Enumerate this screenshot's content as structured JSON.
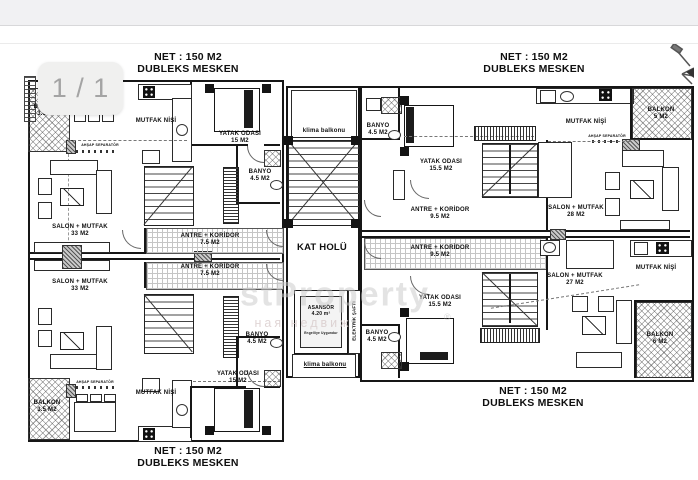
{
  "viewer": {
    "page_badge": "1 / 1"
  },
  "watermark": {
    "logo": "stProperty",
    "registered": "®",
    "tagline": "ная недвиж"
  },
  "plan": {
    "labels": [
      {
        "n": "unit-a-net",
        "t": "NET : 150 M2",
        "x": 188,
        "y": 51,
        "s": 10.5
      },
      {
        "n": "unit-a-type",
        "t": "DUBLEKS MESKEN",
        "x": 188,
        "y": 63,
        "s": 10.5
      },
      {
        "n": "unit-c-net",
        "t": "NET : 150 M2",
        "x": 534,
        "y": 51,
        "s": 10.5
      },
      {
        "n": "unit-c-type",
        "t": "DUBLEKS MESKEN",
        "x": 534,
        "y": 63,
        "s": 10.5
      },
      {
        "n": "unit-b-net",
        "t": "NET : 150 M2",
        "x": 188,
        "y": 445,
        "s": 10.5
      },
      {
        "n": "unit-b-type",
        "t": "DUBLEKS MESKEN",
        "x": 188,
        "y": 457,
        "s": 10.5
      },
      {
        "n": "unit-d-net",
        "t": "NET : 150 M2",
        "x": 533,
        "y": 385,
        "s": 10.5
      },
      {
        "n": "unit-d-type",
        "t": "DUBLEKS MESKEN",
        "x": 533,
        "y": 397,
        "s": 10.5
      },
      {
        "n": "a-balkon",
        "t": "BALKON\n3.5 M2",
        "x": 47,
        "y": 104,
        "s": 6
      },
      {
        "n": "a-mutfak-nisi",
        "t": "MUTFAK NİŞİ",
        "x": 156,
        "y": 118,
        "s": 6
      },
      {
        "n": "a-yatak-odasi",
        "t": "YATAK ODASI\n15 M2",
        "x": 240,
        "y": 131,
        "s": 6
      },
      {
        "n": "a-klima-balkonu",
        "t": "klima balkonu",
        "x": 324,
        "y": 128,
        "s": 6
      },
      {
        "n": "a-ahsap-separator",
        "t": "AHŞAP SEPARATÖR",
        "x": 100,
        "y": 143,
        "s": 3.5
      },
      {
        "n": "a-banyo",
        "t": "BANYO\n4.5 M2",
        "x": 260,
        "y": 169,
        "s": 6
      },
      {
        "n": "a-salon",
        "t": "SALON + MUTFAK\n33 M2",
        "x": 80,
        "y": 224,
        "s": 6
      },
      {
        "n": "a-antre",
        "t": "ANTRE + KORİDOR\n7.5 M2",
        "x": 210,
        "y": 233,
        "s": 6
      },
      {
        "n": "kat-holu",
        "t": "KAT HOLÜ",
        "x": 322,
        "y": 242,
        "s": 9.5
      },
      {
        "n": "b-antre",
        "t": "ANTRE + KORİDOR\n7.5 M2",
        "x": 210,
        "y": 264,
        "s": 6
      },
      {
        "n": "b-salon",
        "t": "SALON + MUTFAK\n33 M2",
        "x": 80,
        "y": 279,
        "s": 6
      },
      {
        "n": "asansor",
        "t": "ASANSÖR\n4.20 m²",
        "x": 321,
        "y": 306,
        "s": 5
      },
      {
        "n": "elektrik-safti",
        "t": "ELEKTRİK ŞAFTI",
        "x": 354,
        "y": 321,
        "s": 4.5,
        "r": 1
      },
      {
        "n": "asansor-note",
        "t": "Engelliye Uygundur",
        "x": 321,
        "y": 332,
        "s": 3.2
      },
      {
        "n": "b-banyo",
        "t": "BANYO\n4.5 M2",
        "x": 257,
        "y": 332,
        "s": 6
      },
      {
        "n": "b-klima-balkonu",
        "t": "klima balkonu",
        "x": 325,
        "y": 362,
        "s": 6,
        "u": 1
      },
      {
        "n": "b-yatak-odasi",
        "t": "YATAK ODASI\n15 M2",
        "x": 238,
        "y": 371,
        "s": 6
      },
      {
        "n": "b-ahsap-separator",
        "t": "AHŞAP SEPARATÖR",
        "x": 95,
        "y": 380,
        "s": 3.5
      },
      {
        "n": "b-mutfak-nisi",
        "t": "MUTFAK NİŞİ",
        "x": 156,
        "y": 390,
        "s": 6
      },
      {
        "n": "b-balkon",
        "t": "BALKON\n3.5 M2",
        "x": 47,
        "y": 400,
        "s": 6
      },
      {
        "n": "c-banyo",
        "t": "BANYO\n4.5 M2",
        "x": 378,
        "y": 123,
        "s": 6
      },
      {
        "n": "c-yatak-odasi",
        "t": "YATAK ODASI\n15.5 M2",
        "x": 441,
        "y": 159,
        "s": 6
      },
      {
        "n": "c-mutfak-nisi",
        "t": "MUTFAK NİŞİ",
        "x": 586,
        "y": 119,
        "s": 6
      },
      {
        "n": "c-balkon",
        "t": "BALKON\n5 M2",
        "x": 661,
        "y": 107,
        "s": 6
      },
      {
        "n": "c-ahsap-separator",
        "t": "AHŞAP SEPARATÖR",
        "x": 607,
        "y": 134,
        "s": 3.5
      },
      {
        "n": "c-salon",
        "t": "SALON + MUTFAK\n28 M2",
        "x": 576,
        "y": 205,
        "s": 6
      },
      {
        "n": "c-antre",
        "t": "ANTRE + KORİDOR\n9.5 M2",
        "x": 440,
        "y": 207,
        "s": 6
      },
      {
        "n": "d-antre",
        "t": "ANTRE + KORİDOR\n9.5 M2",
        "x": 440,
        "y": 245,
        "s": 6
      },
      {
        "n": "d-mutfak-nisi",
        "t": "MUTFAK NİŞİ",
        "x": 656,
        "y": 265,
        "s": 6
      },
      {
        "n": "d-salon",
        "t": "SALON + MUTFAK\n27 M2",
        "x": 575,
        "y": 273,
        "s": 6
      },
      {
        "n": "d-yatak-odasi",
        "t": "YATAK ODASI\n15.5 M2",
        "x": 440,
        "y": 295,
        "s": 6
      },
      {
        "n": "d-banyo",
        "t": "BANYO\n4.5 M2",
        "x": 377,
        "y": 330,
        "s": 6
      },
      {
        "n": "d-balkon",
        "t": "BALKON\n6 M2",
        "x": 660,
        "y": 332,
        "s": 6
      }
    ]
  }
}
